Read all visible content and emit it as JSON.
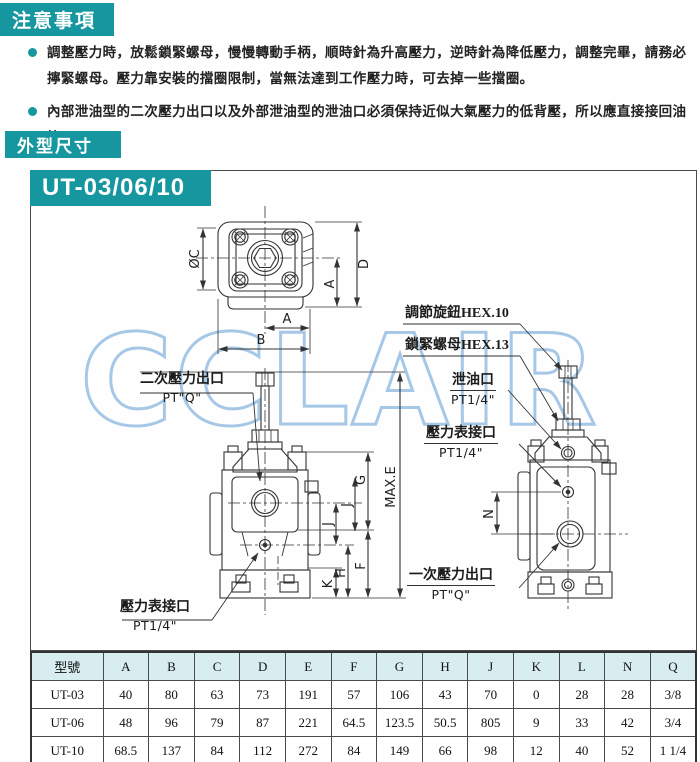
{
  "notice": {
    "title": "注意事項",
    "bullets": [
      "調整壓力時，放鬆鎖緊螺母，慢慢轉動手柄，順時針為升高壓力，逆時針為降低壓力，調整完畢，請務必擰緊螺母。壓力靠安裝的擋圈限制，當無法達到工作壓力時，可去掉一些擋圈。",
      "內部泄油型的二次壓力出口以及外部泄油型的泄油口必須保持近似大氣壓力的低背壓，所以應直接接回油箱。"
    ]
  },
  "dims_section": {
    "title": "外型尺寸",
    "model_badge": "UT-03/06/10"
  },
  "watermark": "CCLAIR",
  "labels": {
    "secondary_outlet": "二次壓力出口",
    "secondary_outlet_size": "PT\"Q\"",
    "gauge_front": "壓力表接口",
    "gauge_front_size": "PT1/4\"",
    "knob": "調節旋鈕HEX.10",
    "locknut": "鎖緊螺母HEX.13",
    "drain": "泄油口",
    "drain_size": "PT1/4\"",
    "gauge_side": "壓力表接口",
    "gauge_side_size": "PT1/4\"",
    "primary_outlet": "一次壓力出口",
    "primary_outlet_size": "PT\"Q\""
  },
  "dims": {
    "c": "ØC",
    "d": "D",
    "a": "A",
    "b": "B",
    "g": "G",
    "f": "F",
    "j": "J",
    "h": "H",
    "k": "K",
    "maxe": "MAX.E",
    "n": "N"
  },
  "table": {
    "headers": [
      "型號",
      "A",
      "B",
      "C",
      "D",
      "E",
      "F",
      "G",
      "H",
      "J",
      "K",
      "L",
      "N",
      "Q"
    ],
    "rows": [
      [
        "UT-03",
        "40",
        "80",
        "63",
        "73",
        "191",
        "57",
        "106",
        "43",
        "70",
        "0",
        "28",
        "28",
        "3/8"
      ],
      [
        "UT-06",
        "48",
        "96",
        "79",
        "87",
        "221",
        "64.5",
        "123.5",
        "50.5",
        "805",
        "9",
        "33",
        "42",
        "3/4"
      ],
      [
        "UT-10",
        "68.5",
        "137",
        "84",
        "112",
        "272",
        "84",
        "149",
        "66",
        "98",
        "12",
        "40",
        "52",
        "1 1/4"
      ]
    ]
  },
  "colors": {
    "teal": "#1697A0",
    "table_header_bg": "#d8edf0",
    "watermark_blue": "#a6c8e6",
    "line": "#333333"
  }
}
